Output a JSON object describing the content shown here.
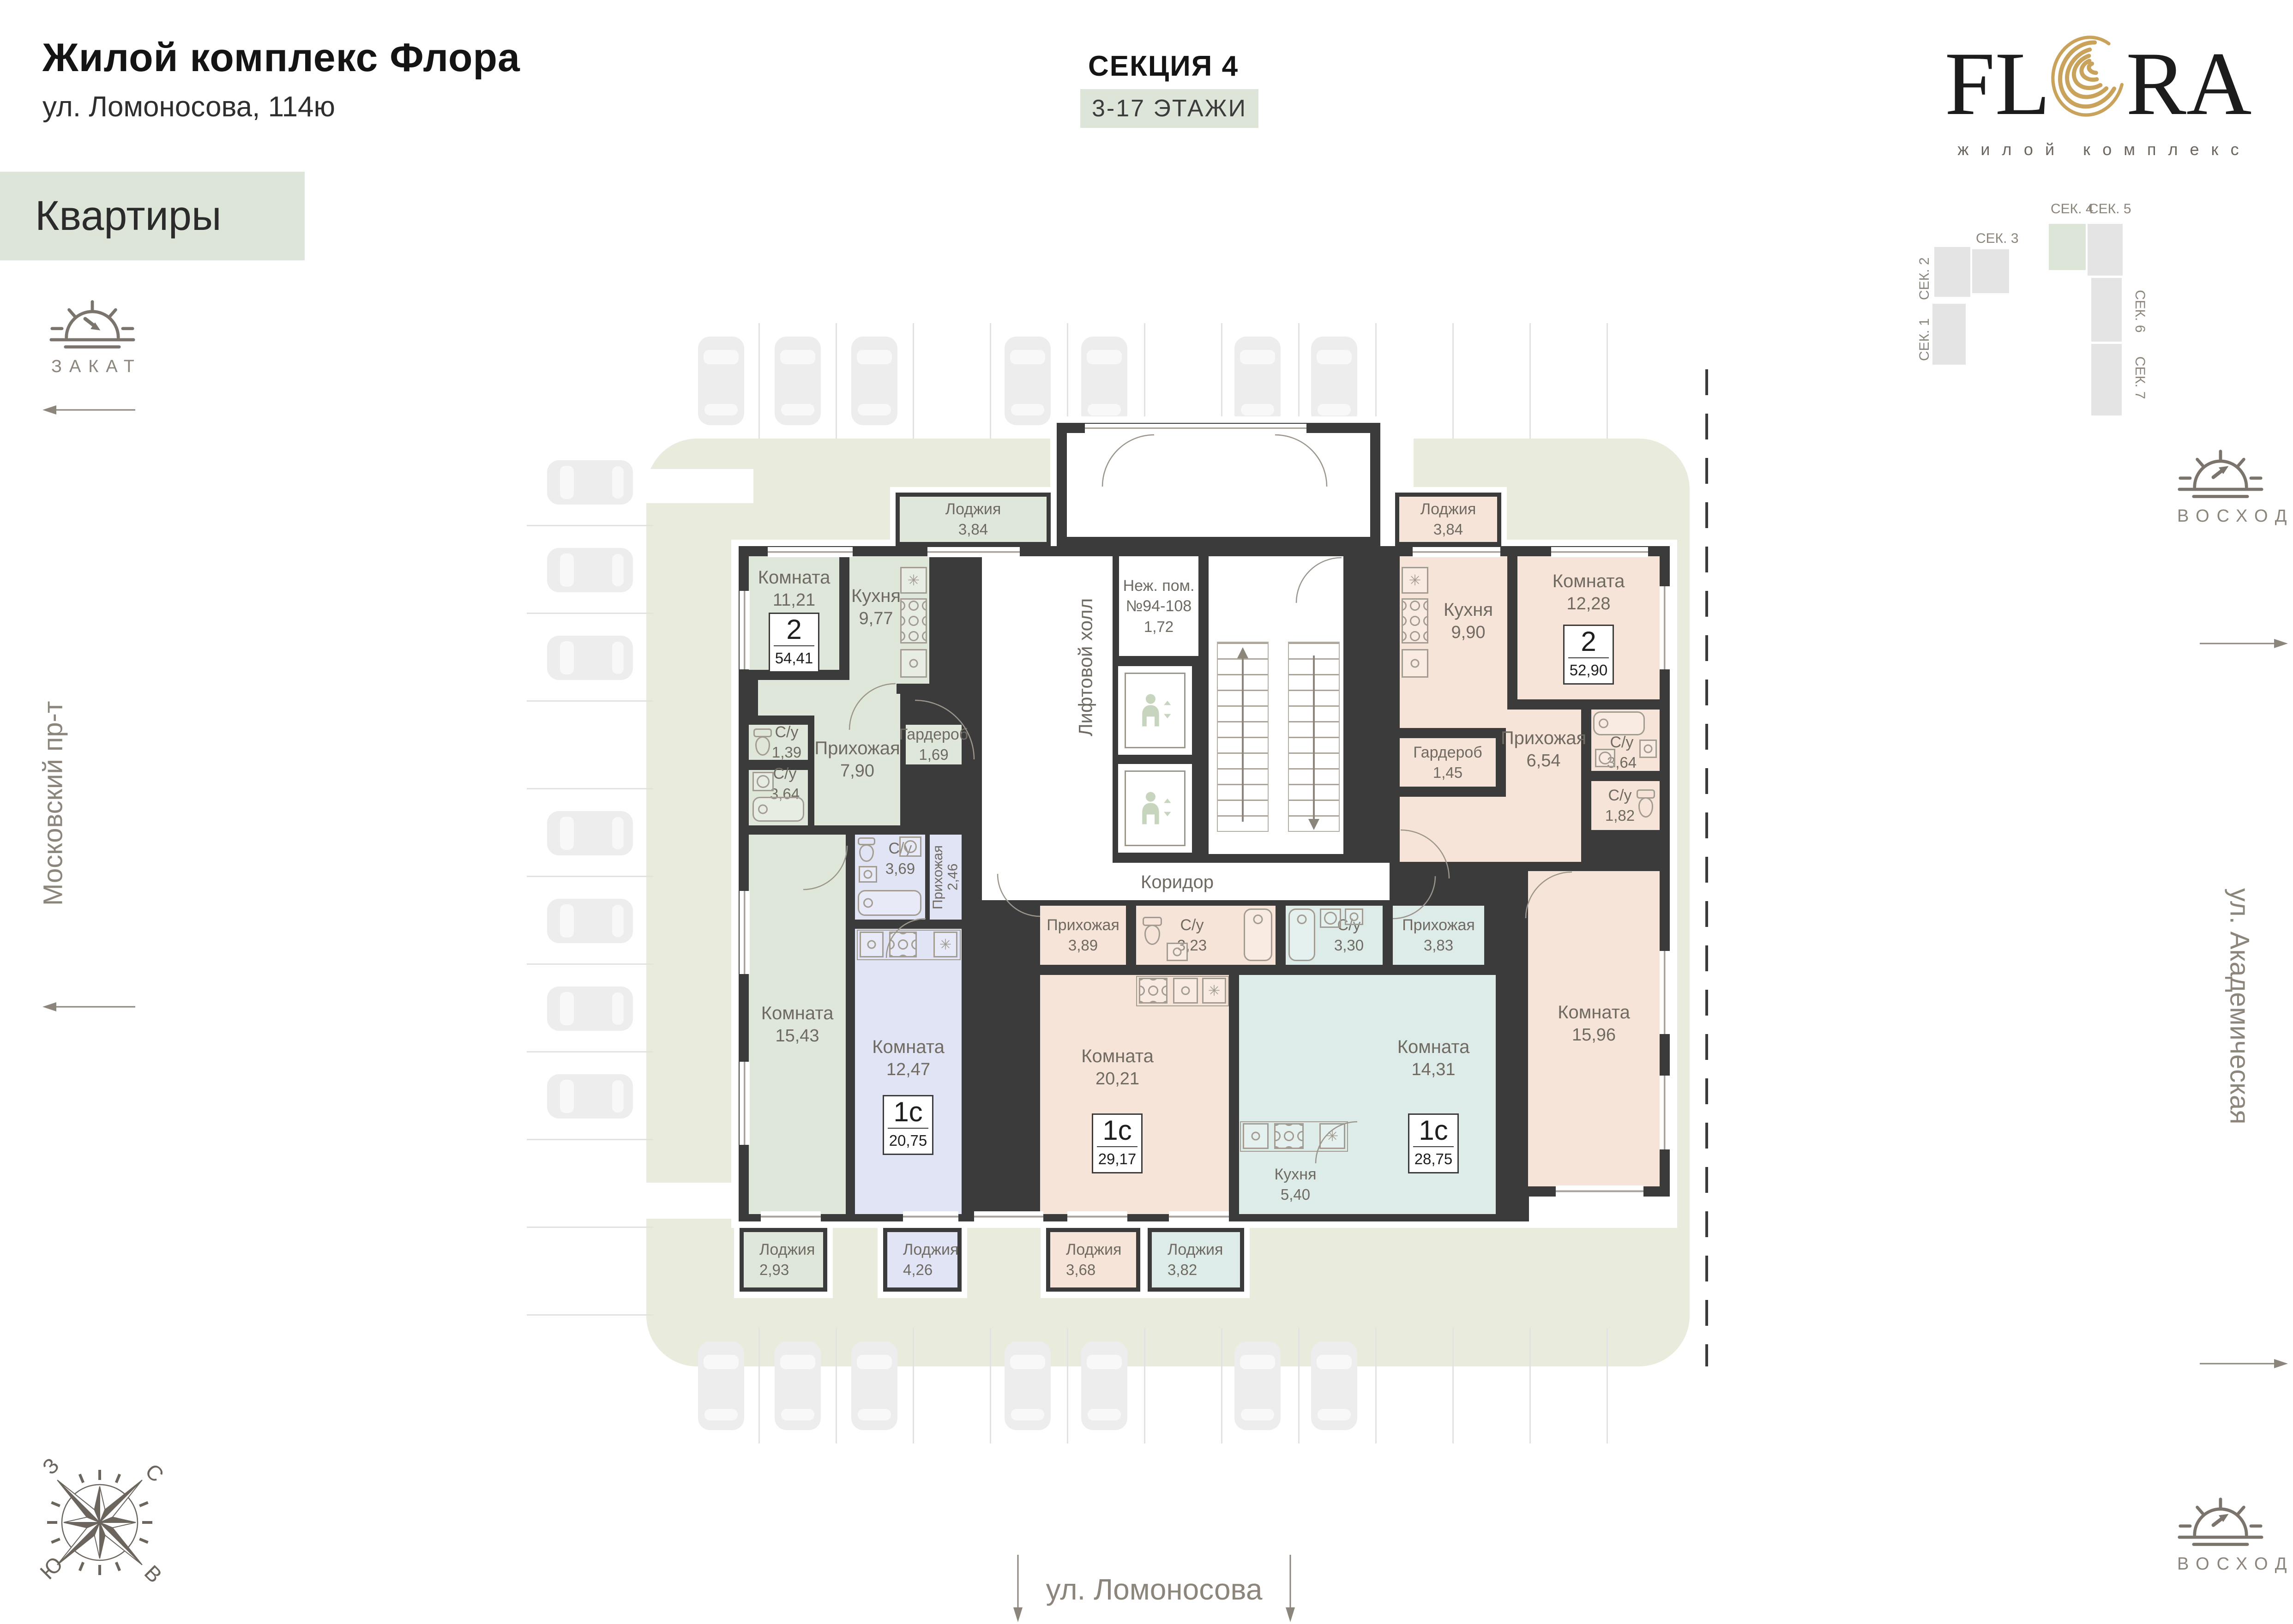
{
  "header": {
    "title": "Жилой комплекс Флора",
    "address": "ул. Ломоносова, 114ю",
    "nav_label": "Квартиры",
    "section_title": "СЕКЦИЯ 4",
    "floors_badge": "3-17 ЭТАЖИ"
  },
  "logo": {
    "fl": "FL",
    "ra": "RA",
    "subtitle": "жилой комплекс"
  },
  "minimap": {
    "sections": {
      "s1": "СЕК. 1",
      "s2": "СЕК. 2",
      "s3": "СЕК. 3",
      "s4": "СЕК. 4",
      "s5": "СЕК. 5",
      "s6": "СЕК. 6",
      "s7": "СЕК. 7"
    },
    "active_section": "СЕК. 4",
    "active_color": "#dce5d8"
  },
  "directions": {
    "sunset_label": "ЗАКАТ",
    "sunrise_label": "ВОСХОД",
    "street_left": "Московский пр-т",
    "street_right": "ул. Академическая",
    "street_bottom": "ул. Ломоносова",
    "compass": {
      "n": "С",
      "s": "Ю",
      "w": "З",
      "e": "В"
    }
  },
  "plan": {
    "core": {
      "lift_hall": "Лифтовой холл",
      "corridor": "Коридор",
      "nonres_l1": "Неж. пом.",
      "nonres_l2": "№94-108",
      "nonres_area": "1,72"
    },
    "apartments": {
      "left2": {
        "type": "2",
        "area": "54,41"
      },
      "right2": {
        "type": "2",
        "area": "52,90"
      },
      "st_left": {
        "type": "1с",
        "area": "20,75"
      },
      "st_mid": {
        "type": "1с",
        "area": "29,17"
      },
      "st_right": {
        "type": "1с",
        "area": "28,75"
      }
    },
    "rooms": {
      "g_loggia_top": {
        "n": "Лоджия",
        "a": "3,84"
      },
      "g_room_a": {
        "n": "Комната",
        "a": "11,21"
      },
      "g_kitchen": {
        "n": "Кухня",
        "a": "9,77"
      },
      "g_wc_small": {
        "n": "С/у",
        "a": "1,39"
      },
      "g_wc_big": {
        "n": "С/у",
        "a": "3,64"
      },
      "g_hall": {
        "n": "Прихожая",
        "a": "7,90"
      },
      "g_ward": {
        "n": "Гардероб",
        "a": "1,69"
      },
      "g_room_b": {
        "n": "Комната",
        "a": "15,43"
      },
      "g_loggia_bot": {
        "n": "Лоджия",
        "a": "2,93"
      },
      "b_wc": {
        "n": "С/у",
        "a": "3,69"
      },
      "b_hall": {
        "n": "Прихожая",
        "a": "2,46"
      },
      "b_room": {
        "n": "Комната",
        "a": "12,47"
      },
      "b_loggia": {
        "n": "Лоджия",
        "a": "4,26"
      },
      "r_loggia_top": {
        "n": "Лоджия",
        "a": "3,84"
      },
      "r_kitchen": {
        "n": "Кухня",
        "a": "9,90"
      },
      "r_room_a": {
        "n": "Комната",
        "a": "12,28"
      },
      "r_ward": {
        "n": "Гардероб",
        "a": "1,45"
      },
      "r_hall": {
        "n": "Прихожая",
        "a": "6,54"
      },
      "r_wc_big": {
        "n": "С/у",
        "a": "3,64"
      },
      "r_wc_small": {
        "n": "С/у",
        "a": "1,82"
      },
      "r_room_b": {
        "n": "Комната",
        "a": "15,96"
      },
      "p_hall": {
        "n": "Прихожая",
        "a": "3,89"
      },
      "p_wc": {
        "n": "С/у",
        "a": "3,23"
      },
      "p_room": {
        "n": "Комната",
        "a": "20,21"
      },
      "p_loggia": {
        "n": "Лоджия",
        "a": "3,68"
      },
      "t_wc": {
        "n": "С/у",
        "a": "3,30"
      },
      "t_hall": {
        "n": "Прихожая",
        "a": "3,83"
      },
      "t_room": {
        "n": "Комната",
        "a": "14,31"
      },
      "t_kitchen": {
        "n": "Кухня",
        "a": "5,40"
      },
      "t_loggia": {
        "n": "Лоджия",
        "a": "3,82"
      }
    }
  },
  "colors": {
    "accent_green": "#dce5d8",
    "room_green": "#dfe7da",
    "room_peach": "#f7e4d8",
    "room_blue": "#e0e4f4",
    "room_teal": "#ddece8",
    "wall": "#3b3b3c",
    "lawn": "#e9ecdd",
    "gold": "#c9a25b",
    "text_gray": "#8c857c"
  }
}
